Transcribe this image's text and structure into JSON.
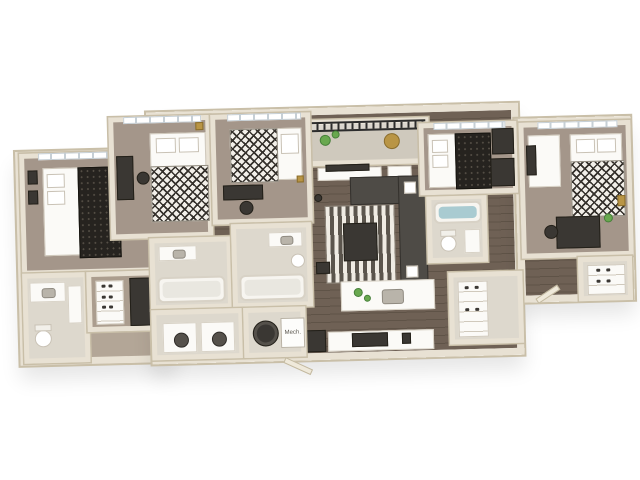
{
  "scene": {
    "type": "3d-floorplan-rendering",
    "view": "isometric top-down apartment floor plan on white background",
    "labels": {
      "mech": "Mech."
    },
    "palette": {
      "background": "#ffffff",
      "walls": "#e8e1d3",
      "wall_edge": "#c9bfa8",
      "bedroom_carpet": "#a4968a",
      "wood_floor": "#6f6155",
      "bath_tile": "#ddd8cd",
      "dark_furniture": "#3a3733",
      "sofa": "#4e4b46",
      "accent_green": "#69a84f",
      "tub_water": "#a9cbd1",
      "railing": "#2c2c2c",
      "accent_gold": "#b99545"
    },
    "rooms": [
      {
        "id": "bedroom-1",
        "name": "Bedroom 1 (far left)"
      },
      {
        "id": "bathroom-1",
        "name": "Bathroom 1"
      },
      {
        "id": "closet-1",
        "name": "Closet / dresser nook"
      },
      {
        "id": "bedroom-2",
        "name": "Bedroom 2"
      },
      {
        "id": "bedroom-3",
        "name": "Bedroom 3"
      },
      {
        "id": "bathroom-2",
        "name": "Bathroom 2"
      },
      {
        "id": "bathroom-3",
        "name": "Bathroom 3"
      },
      {
        "id": "balcony",
        "name": "Balcony"
      },
      {
        "id": "living-room",
        "name": "Living Room"
      },
      {
        "id": "kitchen",
        "name": "Kitchen"
      },
      {
        "id": "kitchen-island",
        "name": "Kitchen Island"
      },
      {
        "id": "laundry",
        "name": "Laundry"
      },
      {
        "id": "mech-closet",
        "name": "Mechanical Closet"
      },
      {
        "id": "pantry",
        "name": "Pantry / Entry Closet"
      },
      {
        "id": "bathroom-4",
        "name": "Bathroom 4"
      },
      {
        "id": "bedroom-4",
        "name": "Bedroom 4"
      },
      {
        "id": "bedroom-5",
        "name": "Bedroom 5 (far right)"
      },
      {
        "id": "closet-5",
        "name": "Closet (far right)"
      }
    ],
    "furniture": [
      "beds with black-and-white patterned duvets",
      "desks with chairs",
      "dressers and wardrobes",
      "sectional sofa",
      "striped area rug",
      "coffee table",
      "tv console",
      "kitchen island with sink and plants",
      "kitchen counter with range and fridge",
      "washer and dryer",
      "water heater",
      "bathtubs",
      "toilets",
      "vanity sinks",
      "balcony railing with plants and cafe table",
      "shoe shelves",
      "pantry shelving"
    ]
  }
}
